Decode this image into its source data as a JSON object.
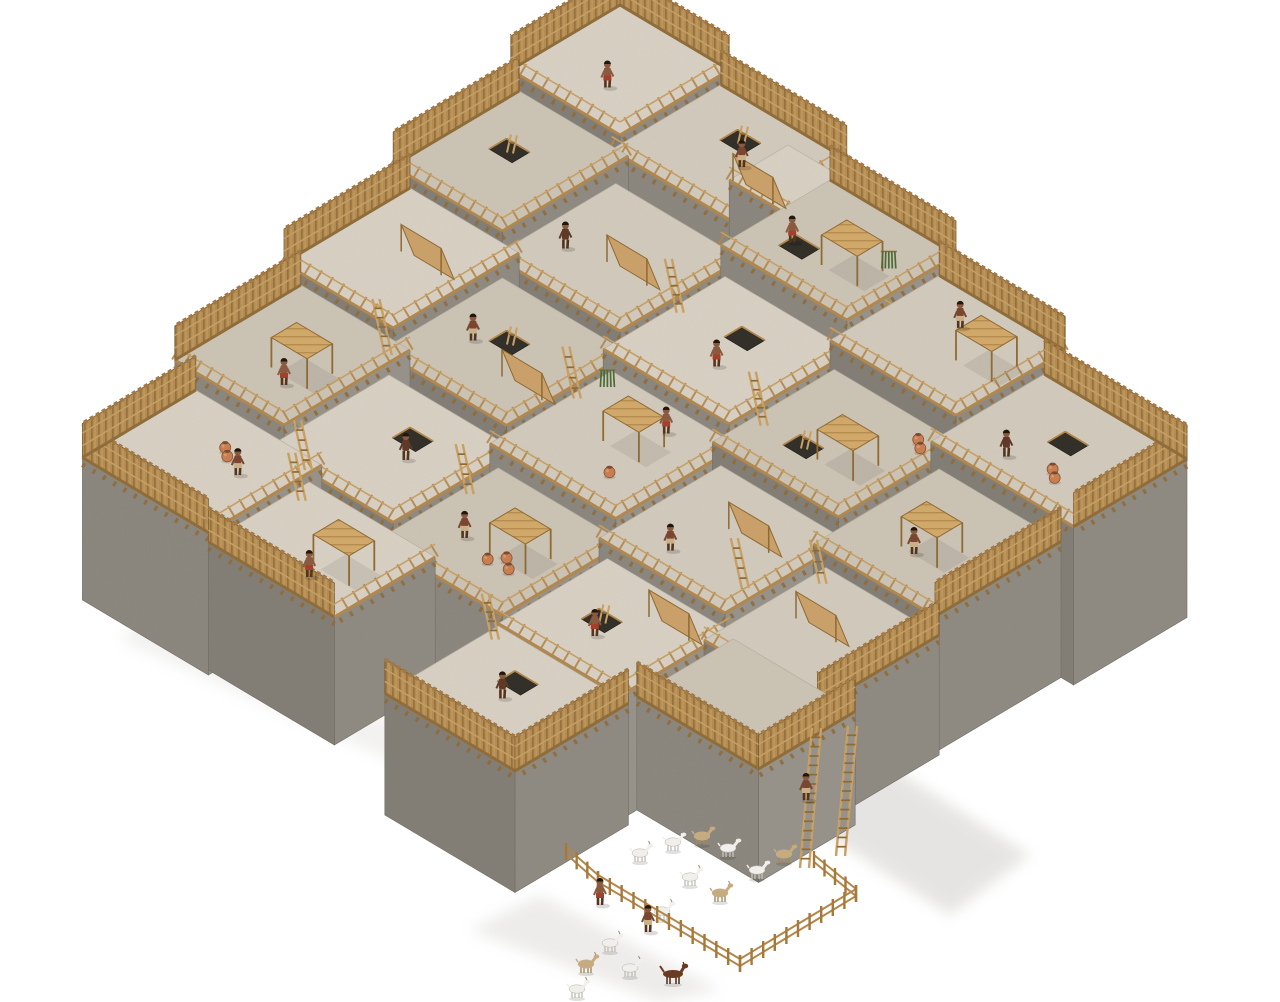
{
  "meta": {
    "title": "3D reconstruction of a Neolithic walled settlement with rooftop terraces, wooden palisades, ladders and an animal pen",
    "background": "#ffffff"
  },
  "palette": {
    "roof": [
      "#d9d2c5",
      "#d3ccbe",
      "#cdc5b6"
    ],
    "wallSE": [
      "#8e8a82",
      "#96928a"
    ],
    "wallSW": [
      "#817d75",
      "#8a867e"
    ],
    "wallEdge": "#6f6b64",
    "roofEdge": "#b7b0a2",
    "wood": "#b3874a",
    "woodDark": "#8f6a33",
    "woodLight": "#c8a063",
    "palisade": "#b58c4f",
    "mat": "#cfa86a",
    "skin": [
      "#7a4630",
      "#8a5a40",
      "#5f3a28"
    ],
    "cloth": [
      "#c9b089",
      "#a33f2a"
    ],
    "pot": "#c77f52",
    "goat": [
      "#f0efec",
      "#c8ab7d"
    ],
    "dog": "#6b3a22",
    "plant": "#4c6b36",
    "shadow": "#b9b5ae"
  },
  "iso": {
    "x0": 620,
    "y0": 205,
    "ux": 42,
    "uy": 25,
    "zu": 80
  },
  "blocks": [
    {
      "id": "A0",
      "u": 0,
      "v": 0,
      "w": 2.6,
      "d": 2.6,
      "h": 2.5,
      "f": [
        "bu",
        "bv"
      ]
    },
    {
      "id": "A1",
      "u": 2.6,
      "v": 0.2,
      "w": 3,
      "d": 2.6,
      "h": 2.38,
      "f": [
        "bu"
      ]
    },
    {
      "id": "T1",
      "u": 5.2,
      "v": 1.2,
      "w": 1.6,
      "d": 1.4,
      "h": 2.75
    },
    {
      "id": "A2",
      "u": 5.6,
      "v": 0.6,
      "w": 3,
      "d": 2.6,
      "h": 2.25,
      "f": [
        "bu"
      ]
    },
    {
      "id": "A3",
      "u": 8.6,
      "v": 1,
      "w": 3,
      "d": 2.6,
      "h": 2.12,
      "f": [
        "bu"
      ]
    },
    {
      "id": "T2",
      "u": 9.3,
      "v": 1.7,
      "w": 1.5,
      "d": 1.3,
      "h": 2.5
    },
    {
      "id": "R1",
      "u": 11.6,
      "v": 1.5,
      "w": 3.4,
      "d": 2.7,
      "h": 1.98,
      "f": [
        "bu",
        "fv"
      ]
    },
    {
      "id": "L1",
      "u": 0.2,
      "v": 2.6,
      "w": 2.6,
      "d": 3,
      "h": 2.3,
      "f": [
        "bv"
      ]
    },
    {
      "id": "L2",
      "u": 0.6,
      "v": 5.6,
      "w": 2.6,
      "d": 3,
      "h": 2.15,
      "f": [
        "bv"
      ]
    },
    {
      "id": "L3",
      "u": 1,
      "v": 8.6,
      "w": 2.6,
      "d": 3,
      "h": 2,
      "f": [
        "bv"
      ]
    },
    {
      "id": "L4",
      "u": 1.5,
      "v": 11.6,
      "w": 3,
      "d": 2.7,
      "h": 1.78,
      "f": [
        "bv",
        "fu"
      ]
    },
    {
      "id": "M1",
      "u": 2.8,
      "v": 2.9,
      "w": 3,
      "d": 2.9,
      "h": 2.05
    },
    {
      "id": "M2",
      "u": 5.8,
      "v": 3.3,
      "w": 3,
      "d": 2.9,
      "h": 1.95
    },
    {
      "id": "M3",
      "u": 8.8,
      "v": 3.7,
      "w": 3,
      "d": 2.9,
      "h": 1.85
    },
    {
      "id": "M4",
      "u": 11.8,
      "v": 4.2,
      "w": 2.9,
      "d": 3,
      "h": 1.7,
      "f": [
        "fv"
      ]
    },
    {
      "id": "M5",
      "u": 3.1,
      "v": 5.9,
      "w": 3,
      "d": 2.9,
      "h": 1.9
    },
    {
      "id": "M6",
      "u": 6.1,
      "v": 6.3,
      "w": 3,
      "d": 2.9,
      "h": 1.8
    },
    {
      "id": "M7",
      "u": 9.1,
      "v": 6.7,
      "w": 3,
      "d": 2.9,
      "h": 1.68
    },
    {
      "id": "M8",
      "u": 3.4,
      "v": 8.9,
      "w": 3,
      "d": 2.9,
      "h": 1.72
    },
    {
      "id": "M9",
      "u": 6.4,
      "v": 9.3,
      "w": 3,
      "d": 2.9,
      "h": 1.62
    },
    {
      "id": "M10",
      "u": 12.1,
      "v": 7.2,
      "w": 2.7,
      "d": 2.9,
      "h": 1.5,
      "f": [
        "fv"
      ]
    },
    {
      "id": "F1",
      "u": 4.4,
      "v": 11.8,
      "w": 3,
      "d": 2.4,
      "h": 1.6,
      "f": [
        "fu"
      ]
    },
    {
      "id": "F3",
      "u": 9.4,
      "v": 9.7,
      "w": 2.9,
      "d": 2.6,
      "h": 1.55
    },
    {
      "id": "F4",
      "u": 12.3,
      "v": 9.6,
      "w": 2.9,
      "d": 2.3,
      "h": 1.42,
      "f": [
        "fv",
        "fu"
      ]
    },
    {
      "id": "B1",
      "u": 9.4,
      "v": 12.3,
      "w": 3.1,
      "d": 2.7,
      "h": 1.52,
      "f": [
        "fu",
        "fv"
      ]
    }
  ],
  "deco": {
    "hatches": [
      [
        "A1",
        1.1,
        0.7,
        1
      ],
      [
        "L1",
        0.8,
        1.1,
        1
      ],
      [
        "M2",
        1.2,
        0.8,
        0
      ],
      [
        "M3",
        0.9,
        1.7,
        1
      ],
      [
        "R1",
        1.4,
        0.9,
        0
      ],
      [
        "M5",
        1.1,
        1.0,
        1
      ],
      [
        "M8",
        1.3,
        0.8,
        0
      ],
      [
        "B1",
        1.1,
        0.7,
        0
      ],
      [
        "F3",
        0.9,
        1.1,
        1
      ],
      [
        "A2",
        0.7,
        1.5,
        0
      ]
    ],
    "canopies": [
      [
        "A2",
        1.6,
        1.2
      ],
      [
        "A3",
        1.9,
        0.9
      ],
      [
        "M3",
        1.6,
        1.4
      ],
      [
        "M6",
        1.3,
        0.9
      ],
      [
        "M9",
        1.6,
        1.2
      ],
      [
        "L3",
        1.3,
        1.4
      ],
      [
        "F1",
        1.7,
        1.0
      ],
      [
        "M4",
        1.1,
        1.4
      ]
    ],
    "leantos": [
      [
        "M1",
        1.7,
        1.6
      ],
      [
        "M7",
        1.6,
        1.1
      ],
      [
        "L2",
        1.4,
        1.3
      ],
      [
        "F3",
        1.9,
        0.6
      ],
      [
        "M10",
        0.9,
        1.3
      ],
      [
        "M5",
        2.2,
        1.9
      ],
      [
        "A1",
        2.3,
        1.7
      ]
    ],
    "ladders": [
      [
        "L3",
        2.4,
        0.4,
        56
      ],
      [
        "M2",
        0.15,
        1.3,
        54
      ],
      [
        "M6",
        0.1,
        1.0,
        52
      ],
      [
        "M9",
        0.15,
        0.9,
        50
      ],
      [
        "F1",
        0.25,
        0.5,
        48
      ],
      [
        "M3",
        0.25,
        2.0,
        54
      ],
      [
        "B1",
        0.2,
        0.35,
        46
      ],
      [
        "M7",
        2.7,
        2.2,
        50
      ],
      [
        "M10",
        0.25,
        0.4,
        44
      ],
      [
        "L4",
        2.9,
        0.3,
        50
      ]
    ],
    "pots": [
      [
        "M9",
        2.0,
        1.8
      ],
      [
        "M9",
        2.25,
        2.0
      ],
      [
        "M9",
        1.8,
        2.05
      ],
      [
        "L4",
        1.6,
        0.9
      ],
      [
        "L4",
        1.8,
        1.05
      ],
      [
        "M3",
        2.5,
        0.5
      ],
      [
        "M3",
        2.7,
        0.65
      ],
      [
        "R1",
        2.1,
        1.9
      ],
      [
        "R1",
        2.3,
        2.05
      ],
      [
        "M6",
        2.1,
        2.15
      ]
    ],
    "plants": [
      [
        "A2",
        2.65,
        1.25
      ],
      [
        "M6",
        0.45,
        0.55
      ]
    ],
    "tall_ladders": [
      [
        800,
        868,
        140
      ],
      [
        836,
        856,
        130
      ]
    ]
  },
  "figures": {
    "people": [
      [
        "A1",
        1.9,
        1.4,
        0
      ],
      [
        "A2",
        0.8,
        1.7,
        1
      ],
      [
        "A3",
        1.3,
        0.8,
        0
      ],
      [
        "R1",
        1.2,
        2.1,
        2
      ],
      [
        "M2",
        1.7,
        1.9,
        1
      ],
      [
        "M5",
        0.9,
        1.6,
        0
      ],
      [
        "M6",
        1.9,
        0.6,
        1
      ],
      [
        "M8",
        1.9,
        1.5,
        2
      ],
      [
        "M9",
        1.0,
        1.8,
        0
      ],
      [
        "L3",
        1.8,
        2.2,
        1
      ],
      [
        "L4",
        2.2,
        1.2,
        0
      ],
      [
        "F1",
        1.9,
        1.9,
        1
      ],
      [
        "B1",
        1.5,
        1.4,
        2
      ],
      [
        "M4",
        1.4,
        2.0,
        0
      ],
      [
        "F3",
        1.4,
        1.7,
        1
      ],
      [
        "M7",
        1.1,
        2.3,
        0
      ],
      [
        "M1",
        0.7,
        1.9,
        2
      ],
      [
        "A0",
        1.5,
        1.8,
        1
      ]
    ],
    "ground_people": [
      [
        600,
        905,
        1
      ],
      [
        648,
        932,
        0
      ]
    ],
    "climbers": [
      [
        806,
        800,
        0
      ]
    ],
    "goats": [
      [
        640,
        862,
        0
      ],
      [
        673,
        851,
        0
      ],
      [
        702,
        845,
        1
      ],
      [
        728,
        857,
        0
      ],
      [
        690,
        886,
        0
      ],
      [
        720,
        902,
        1
      ],
      [
        757,
        879,
        0
      ],
      [
        784,
        863,
        1
      ],
      [
        662,
        920,
        0
      ],
      [
        610,
        952,
        0
      ],
      [
        586,
        973,
        1
      ],
      [
        630,
        977,
        0
      ],
      [
        577,
        998,
        0
      ]
    ],
    "dog": [
      673,
      984
    ]
  },
  "pen": {
    "segments": [
      [
        598,
        888,
        740,
        972
      ],
      [
        740,
        972,
        856,
        902
      ],
      [
        856,
        902,
        814,
        868
      ],
      [
        598,
        888,
        566,
        860
      ]
    ]
  },
  "shadows": [
    {
      "pts": [
        [
          1048,
          520
        ],
        [
          1165,
          600
        ],
        [
          1095,
          655
        ],
        [
          985,
          568
        ]
      ],
      "o": 0.3
    },
    {
      "pts": [
        [
          856,
          745
        ],
        [
          1030,
          855
        ],
        [
          950,
          915
        ],
        [
          780,
          805
        ]
      ],
      "o": 0.35
    },
    {
      "pts": [
        [
          540,
          895
        ],
        [
          720,
          990
        ],
        [
          660,
          1002
        ],
        [
          470,
          930
        ]
      ],
      "o": 0.25
    },
    {
      "pts": [
        [
          150,
          610
        ],
        [
          520,
          780
        ],
        [
          480,
          800
        ],
        [
          120,
          640
        ]
      ],
      "o": 0.18
    }
  ]
}
